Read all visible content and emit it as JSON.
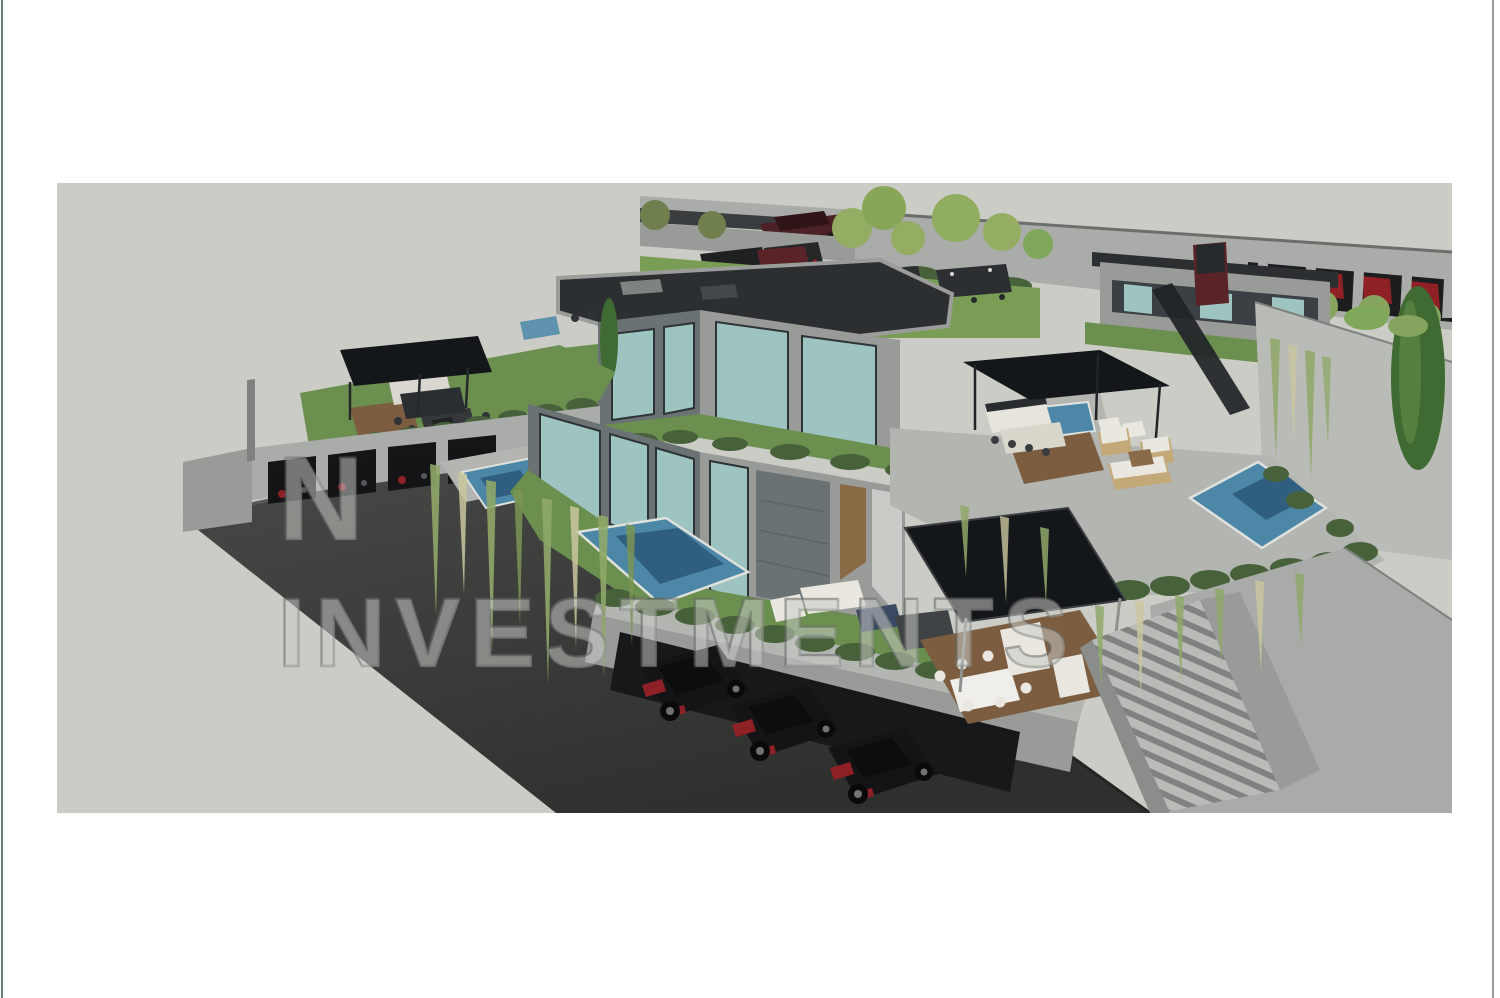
{
  "page": {
    "background": "#ffffff"
  },
  "frame": {
    "left_edge_line_color": "#4a6a64",
    "right_edge_line_color": "#8d9390"
  },
  "canvas": {
    "background": "#cbccc6"
  },
  "watermark": {
    "line1": "N",
    "line2": "INVESTMENTS",
    "wm_fill": "rgba(235,236,230,0.18)",
    "wm_stroke": "rgba(108,113,108,0.45)"
  },
  "palette": {
    "left_edge_line_color": "#4a6a64",
    "right_edge_line_color": "#8d9390",
    "canvas_bg": "#cbccc6",
    "road_light": "#4a4b48",
    "road_dark": "#2f302e",
    "roof": "#2b2f31",
    "canopy": "#14171a",
    "wall_light": "#a9aca8",
    "wall_mid": "#989b97",
    "wall_stone": "#6a7274",
    "deck_gray": "#b3b5b1",
    "grass": "#6b8f4e",
    "grass_light": "#7a9d55",
    "hedge": "#47623a",
    "pool": "#4c87a8",
    "pool_deep": "#2f5e7e",
    "glass": "#9ec4c1",
    "car_body": "#141417",
    "car_accent": "#8e2026",
    "wood": "#7c5d40",
    "furniture_white": "#e9e7df",
    "vine": "#8fa768",
    "vine_light": "#c9c79f",
    "cypress": "#3f6b33",
    "tree_light": "#94ad62",
    "wm_fill": "rgba(235,236,230,0.18)",
    "wm_stroke": "rgba(108,113,108,0.45)"
  },
  "scene": {
    "elements": [
      "terraced-villa",
      "green-roof-terraces",
      "swimming-pools",
      "pergola-canopies",
      "garage-cars",
      "street-parking-bays",
      "cascading-vines",
      "outdoor-lounge",
      "outdoor-dining",
      "staircase",
      "cypress-tree",
      "asphalt-road"
    ]
  }
}
